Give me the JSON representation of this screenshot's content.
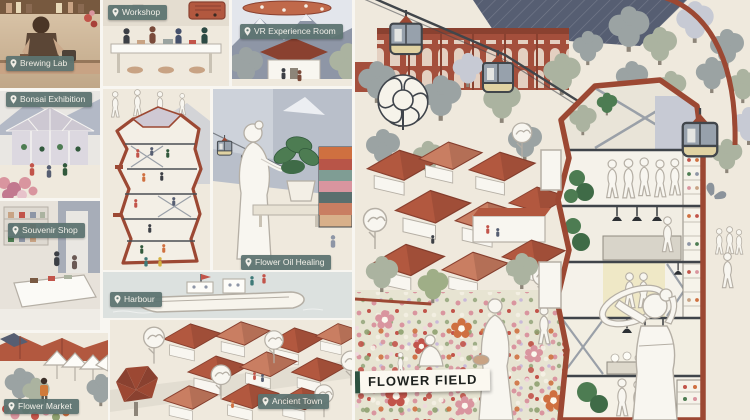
{
  "labels": {
    "workshop": "Workshop",
    "brewing_lab": "Brewing Lab",
    "vr_experience_room": "VR Experience Room",
    "bonsai_exhibition": "Bonsai Exhibition",
    "souvenir_shop": "Souvenir Shop",
    "flower_oil_healing": "Flower Oil Healing",
    "harbour": "Harbour",
    "flower_market": "Flower Market",
    "ancient_town": "Ancient Town",
    "flower_field": "FLOWER FIELD"
  },
  "icons": {
    "location_pin": "map-pin drop shape on every teal zone label",
    "cable_car": "gondola cabin hanging from cable",
    "butterfly": "small grey butterfly",
    "pendant_lamp": "black hanging cone lamp"
  },
  "colors": {
    "board_bg": "#f8f6f1",
    "panel_cream": "#efe9dd",
    "label_teal": "#5d7471",
    "label_text": "#f3f1ea",
    "field_label_bg": "#fbf8f0",
    "field_label_text": "#1c201d",
    "field_label_bar": "#2c5140",
    "brick_red": "#9c4833",
    "roof_red": "#b2583f",
    "roof_dark": "#8a4130",
    "roof_light": "#c97e62",
    "outline_dark": "#41464b",
    "slate": "#8e96a6",
    "slate_dark": "#565e72",
    "slate_light": "#c7cad4",
    "tree_grey": "#9ba3a3",
    "sage": "#abb3a0",
    "gondola_body": "#97a1ac",
    "gondola_band": "#e0d2a2",
    "plant_green": "#4d7c52",
    "plant_dark": "#31593c",
    "flower_pink": "#d9959f",
    "flower_red": "#c2544a",
    "field_base": "#e7e4d2",
    "field_green": "#9fae87",
    "figure_white": "#f8f6f0",
    "figure_line": "#b5afa5",
    "wood_tan": "#c8a384",
    "wood_dark": "#77593f",
    "water": "#dce1df",
    "mural_orange": "#cf7040"
  }
}
